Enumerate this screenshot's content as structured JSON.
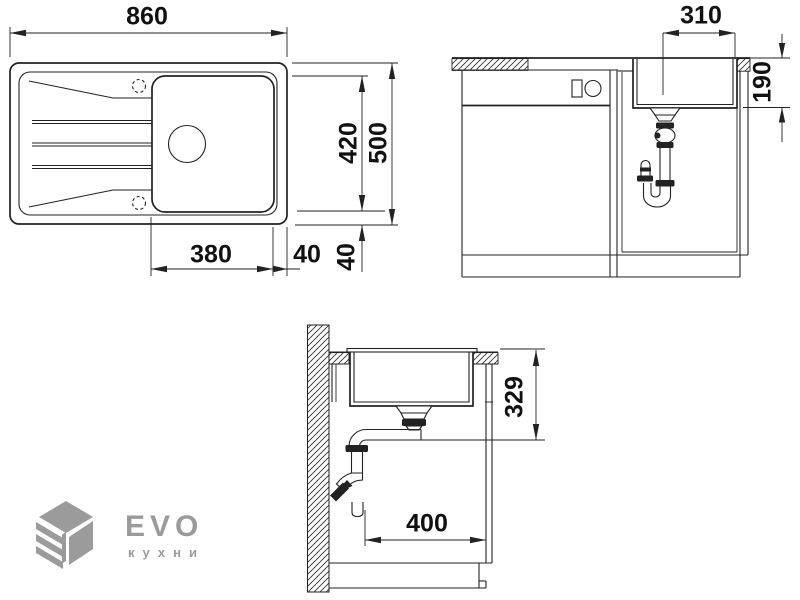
{
  "drawing": {
    "title": "Sink installation technical drawing",
    "dims": {
      "overall_width": "860",
      "inner_depth": "420",
      "overall_depth": "500",
      "bowl_width": "380",
      "bowl_side_offset": "40",
      "bowl_bottom_offset": "40",
      "front_bowl_width": "310",
      "front_bowl_depth": "190",
      "side_drain_depth": "329",
      "side_drain_offset": "400"
    }
  },
  "logo": {
    "brand": "EVO",
    "subtitle": "кухни"
  },
  "colors": {
    "line": "#222222",
    "text": "#111111",
    "logo": "#9b9b9b",
    "background": "#ffffff"
  }
}
